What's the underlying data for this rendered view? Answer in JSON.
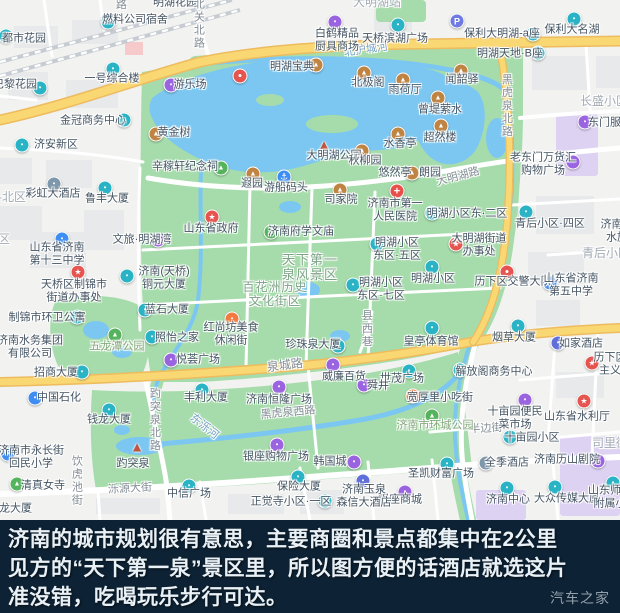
{
  "colors": {
    "base": "#f2f3f1",
    "block": "#e7e9ea",
    "park_green": "#a6dcab",
    "water_blue": "#7cc7f1",
    "road_yellow": "#f9d873",
    "road_yellow_edge": "#eebb5e",
    "road_white": "#ffffff",
    "railway": "#c6ccd2",
    "purple_block": "#ded2f3",
    "pink_block": "#f6caca",
    "caption_bg": "#0d2234",
    "caption_fg": "#e9f1f6",
    "icon_teal": "#29b3c5",
    "icon_purple": "#9a63e0",
    "icon_amber": "#c08442",
    "icon_blue": "#3e8df2",
    "icon_green": "#54b35c",
    "icon_red": "#e65450",
    "icon_orange": "#f27a40"
  },
  "map": {
    "icon_glyphs": {
      "teal": "▪",
      "purple": "▪",
      "amber": "▲",
      "blue": "▪",
      "green": "▲",
      "slate": "▪",
      "indigo": "▪",
      "orange": "▪",
      "red": "▪",
      "dot": "●",
      "star": "★",
      "cross": "+",
      "parking": "P",
      "anchor": "⚓",
      "pagoda": "▲"
    },
    "labels": [
      {
        "t": "路",
        "x": 120,
        "y": 5,
        "c": "road",
        "v": 1
      },
      {
        "t": "明湖花园",
        "x": 175,
        "y": 3,
        "c": "poi"
      },
      {
        "t": "北关北路",
        "x": 198,
        "y": 24,
        "c": "road",
        "v": 1
      },
      {
        "t": "大明湖站",
        "x": 377,
        "y": 3,
        "c": "dist"
      },
      {
        "t": "北护城河",
        "x": 366,
        "y": 50,
        "c": "water",
        "r": -8
      },
      {
        "t": "黑虎泉北路",
        "x": 506,
        "y": 106,
        "c": "road",
        "v": 1
      },
      {
        "t": "大明湖路",
        "x": 458,
        "y": 177,
        "c": "road",
        "r": -15
      },
      {
        "t": "长盛小区",
        "x": 604,
        "y": 102,
        "c": "dist"
      },
      {
        "t": "青后小区",
        "x": 606,
        "y": 254,
        "c": "dist"
      },
      {
        "t": "司里街",
        "x": 610,
        "y": 444,
        "c": "dist"
      },
      {
        "t": "区-北区",
        "x": 6,
        "y": 198,
        "c": "dist"
      },
      {
        "t": "区",
        "x": 4,
        "y": 240,
        "c": "dist"
      },
      {
        "t": "县西巷",
        "x": 366,
        "y": 329,
        "c": "road",
        "v": 1
      },
      {
        "t": "泉城路",
        "x": 285,
        "y": 366,
        "c": "road",
        "r": -7,
        "s": 12
      },
      {
        "t": "黑虎泉西路",
        "x": 288,
        "y": 413,
        "c": "road",
        "r": -5
      },
      {
        "t": "东泺河",
        "x": 204,
        "y": 427,
        "c": "water",
        "r": 38
      },
      {
        "t": "趵突泉北路",
        "x": 154,
        "y": 420,
        "c": "road",
        "v": 1
      },
      {
        "t": "饮虎池街",
        "x": 76,
        "y": 481,
        "c": "road",
        "v": 1
      },
      {
        "t": "泺源大街",
        "x": 130,
        "y": 489,
        "c": "road",
        "r": -3
      },
      {
        "t": "半边街",
        "x": 486,
        "y": 429,
        "c": "road",
        "r": -3
      },
      {
        "t": "天下第一|泉风景区",
        "x": 310,
        "y": 268,
        "c": "green",
        "s": 13
      },
      {
        "t": "百花洲历史|文化街区",
        "x": 275,
        "y": 295,
        "c": "green",
        "s": 12
      },
      {
        "t": "五龙潭公园",
        "x": 117,
        "y": 347,
        "c": "green2"
      },
      {
        "t": "济南市环城公园",
        "x": 435,
        "y": 426,
        "c": "green2"
      },
      {
        "t": "燃料公司宿舍",
        "x": 135,
        "y": 20,
        "c": "poi"
      },
      {
        "t": "都市花园",
        "x": 24,
        "y": 39,
        "c": "poi"
      },
      {
        "t": "白鹤精品|厨具商场",
        "x": 337,
        "y": 40,
        "c": "poi"
      },
      {
        "t": "天桥滨湖广场",
        "x": 395,
        "y": 39,
        "c": "poi"
      },
      {
        "t": "保利大名湖",
        "x": 572,
        "y": 30,
        "c": "poi"
      },
      {
        "t": "保利大明湖-a座",
        "x": 502,
        "y": 34,
        "c": "poi"
      },
      {
        "t": "明湖天地·B座",
        "x": 510,
        "y": 54,
        "c": "poi"
      },
      {
        "t": "一号综合楼",
        "x": 112,
        "y": 79,
        "c": "poi"
      },
      {
        "t": "巴黎花园",
        "x": 15,
        "y": 85,
        "c": "poi"
      },
      {
        "t": "金冠商务中心",
        "x": 93,
        "y": 121,
        "c": "poi"
      },
      {
        "t": "济安新区",
        "x": 56,
        "y": 145,
        "c": "poi"
      },
      {
        "t": "游乐场",
        "x": 190,
        "y": 85,
        "c": "poi"
      },
      {
        "t": "明湖宝典",
        "x": 292,
        "y": 67,
        "c": "poi"
      },
      {
        "t": "北极阁",
        "x": 368,
        "y": 83,
        "c": "poi"
      },
      {
        "t": "雨荷厅",
        "x": 405,
        "y": 90,
        "c": "poi"
      },
      {
        "t": "黄金树",
        "x": 174,
        "y": 133,
        "c": "poi"
      },
      {
        "t": "闻韶驿",
        "x": 462,
        "y": 80,
        "c": "poi"
      },
      {
        "t": "曾堤萦水",
        "x": 440,
        "y": 110,
        "c": "poi"
      },
      {
        "t": "超然楼",
        "x": 440,
        "y": 138,
        "c": "poi"
      },
      {
        "t": "水香亭",
        "x": 400,
        "y": 144,
        "c": "poi"
      },
      {
        "t": "大明湖公园",
        "x": 334,
        "y": 156,
        "c": "poi"
      },
      {
        "t": "秋柳园",
        "x": 365,
        "y": 161,
        "c": "poi"
      },
      {
        "t": "悠然亭",
        "x": 395,
        "y": 173,
        "c": "poi"
      },
      {
        "t": "朗园",
        "x": 430,
        "y": 173,
        "c": "poi"
      },
      {
        "t": "司家院",
        "x": 341,
        "y": 200,
        "c": "poi"
      },
      {
        "t": "游船码头",
        "x": 286,
        "y": 188,
        "c": "poi"
      },
      {
        "t": "遐园",
        "x": 252,
        "y": 184,
        "c": "poi"
      },
      {
        "t": "辛稼轩纪念祠",
        "x": 185,
        "y": 167,
        "c": "poi"
      },
      {
        "t": "济南市第一|人民医院",
        "x": 395,
        "y": 210,
        "c": "poi"
      },
      {
        "t": "明湖小区东·二区",
        "x": 467,
        "y": 214,
        "c": "poi"
      },
      {
        "t": "青后小区·四区",
        "x": 550,
        "y": 224,
        "c": "poi"
      },
      {
        "t": "文旅·明湖湾",
        "x": 142,
        "y": 240,
        "c": "poi"
      },
      {
        "t": "彩虹大酒店",
        "x": 53,
        "y": 194,
        "c": "poi"
      },
      {
        "t": "鲁丰大厦",
        "x": 107,
        "y": 199,
        "c": "poi"
      },
      {
        "t": "山东省济南|第十三中学",
        "x": 57,
        "y": 254,
        "c": "poi"
      },
      {
        "t": "山东省政府",
        "x": 211,
        "y": 229,
        "c": "poi"
      },
      {
        "t": "济南府学文庙",
        "x": 301,
        "y": 232,
        "c": "poi"
      },
      {
        "t": "天桥区制锦市|街道办事处",
        "x": 74,
        "y": 291,
        "c": "poi"
      },
      {
        "t": "济南(天桥)|铜元大厦",
        "x": 164,
        "y": 278,
        "c": "poi"
      },
      {
        "t": "蓝石大厦",
        "x": 167,
        "y": 310,
        "c": "poi"
      },
      {
        "t": "明湖小区|东区·五区",
        "x": 397,
        "y": 249,
        "c": "poi"
      },
      {
        "t": "明湖小区|东区·七区",
        "x": 381,
        "y": 289,
        "c": "poi"
      },
      {
        "t": "明湖小区",
        "x": 433,
        "y": 279,
        "c": "poi"
      },
      {
        "t": "大明湖街道|办事处",
        "x": 479,
        "y": 245,
        "c": "poi"
      },
      {
        "t": "历下区交警大队",
        "x": 513,
        "y": 282,
        "c": "poi"
      },
      {
        "t": "济南解|水族",
        "x": 617,
        "y": 231,
        "c": "poi"
      },
      {
        "t": "山东省济南|第五中学",
        "x": 571,
        "y": 285,
        "c": "poi"
      },
      {
        "t": "东门服装",
        "x": 610,
        "y": 123,
        "c": "poi"
      },
      {
        "t": "老东门万货汇|购物广场",
        "x": 543,
        "y": 164,
        "c": "poi"
      },
      {
        "t": "历下区|主义",
        "x": 610,
        "y": 364,
        "c": "poi"
      },
      {
        "t": "山东省水利厅",
        "x": 577,
        "y": 417,
        "c": "poi"
      },
      {
        "t": "烟草大厦",
        "x": 514,
        "y": 338,
        "c": "poi"
      },
      {
        "t": "如家酒店",
        "x": 581,
        "y": 344,
        "c": "poi"
      },
      {
        "t": "皇亭体育馆",
        "x": 431,
        "y": 342,
        "c": "poi"
      },
      {
        "t": "解放阁商务中心",
        "x": 494,
        "y": 372,
        "c": "poi"
      },
      {
        "t": "世茂广场",
        "x": 402,
        "y": 379,
        "c": "poi"
      },
      {
        "t": "宽厚里小吃街",
        "x": 440,
        "y": 398,
        "c": "poi"
      },
      {
        "t": "十亩园便民|菜市场",
        "x": 515,
        "y": 418,
        "c": "poi"
      },
      {
        "t": "十亩园小区",
        "x": 532,
        "y": 438,
        "c": "poi"
      },
      {
        "t": "全季酒店",
        "x": 507,
        "y": 463,
        "c": "poi"
      },
      {
        "t": "济南历山剧院",
        "x": 567,
        "y": 460,
        "c": "poi"
      },
      {
        "t": "圣凯财富广场",
        "x": 441,
        "y": 474,
        "c": "poi"
      },
      {
        "t": "济南中心",
        "x": 508,
        "y": 500,
        "c": "poi"
      },
      {
        "t": "大众传媒大厦",
        "x": 567,
        "y": 499,
        "c": "poi"
      },
      {
        "t": "山东师范|附属小",
        "x": 610,
        "y": 497,
        "c": "poi"
      },
      {
        "t": "银座商城",
        "x": 400,
        "y": 500,
        "c": "poi"
      },
      {
        "t": "保险大厦",
        "x": 299,
        "y": 487,
        "c": "poi"
      },
      {
        "t": "正觉寺小区·一区",
        "x": 291,
        "y": 502,
        "c": "poi"
      },
      {
        "t": "济南玉泉|森信大酒店",
        "x": 364,
        "y": 496,
        "c": "poi"
      },
      {
        "t": "韩国城",
        "x": 330,
        "y": 462,
        "c": "poi"
      },
      {
        "t": "银座购物广场",
        "x": 276,
        "y": 457,
        "c": "poi"
      },
      {
        "t": "中信广场",
        "x": 189,
        "y": 494,
        "c": "poi"
      },
      {
        "t": "金龙大厦",
        "x": 10,
        "y": 509,
        "c": "poi"
      },
      {
        "t": "趵突泉",
        "x": 133,
        "y": 464,
        "c": "poi"
      },
      {
        "t": "清真女寺",
        "x": 43,
        "y": 486,
        "c": "poi"
      },
      {
        "t": "济南市永长街|回民小学",
        "x": 31,
        "y": 457,
        "c": "poi"
      },
      {
        "t": "中国石化",
        "x": 59,
        "y": 398,
        "c": "poi"
      },
      {
        "t": "招商大厦",
        "x": 56,
        "y": 373,
        "c": "poi"
      },
      {
        "t": "济南水务集团|有限公司",
        "x": 30,
        "y": 347,
        "c": "poi"
      },
      {
        "t": "制锦市环卫公寓",
        "x": 47,
        "y": 318,
        "c": "poi"
      },
      {
        "t": "照怡之家",
        "x": 177,
        "y": 338,
        "c": "poi"
      },
      {
        "t": "悦荟广场",
        "x": 198,
        "y": 360,
        "c": "poi"
      },
      {
        "t": "丰利大厦",
        "x": 206,
        "y": 398,
        "c": "poi"
      },
      {
        "t": "钱龙大厦",
        "x": 109,
        "y": 420,
        "c": "poi"
      },
      {
        "t": "济南恒隆广场",
        "x": 279,
        "y": 400,
        "c": "poi"
      },
      {
        "t": "珍珠泉大厦",
        "x": 313,
        "y": 345,
        "c": "poi"
      },
      {
        "t": "威廉百货",
        "x": 344,
        "y": 377,
        "c": "poi"
      },
      {
        "t": "舜井",
        "x": 378,
        "y": 386,
        "c": "poi"
      },
      {
        "t": "红尚坊美食|休闲街",
        "x": 231,
        "y": 334,
        "c": "poi"
      }
    ],
    "icons": [
      {
        "x": 108,
        "y": 22,
        "k": "teal"
      },
      {
        "x": 6,
        "y": 36,
        "k": "teal"
      },
      {
        "x": 335,
        "y": 22,
        "k": "purple"
      },
      {
        "x": 398,
        "y": 25,
        "k": "teal"
      },
      {
        "x": 574,
        "y": 19,
        "k": "teal"
      },
      {
        "x": 533,
        "y": 34,
        "k": "teal"
      },
      {
        "x": 538,
        "y": 53,
        "k": "teal"
      },
      {
        "x": 457,
        "y": 21,
        "k": "parking"
      },
      {
        "x": 113,
        "y": 69,
        "k": "teal"
      },
      {
        "x": 40,
        "y": 88,
        "k": "teal"
      },
      {
        "x": 124,
        "y": 120,
        "k": "teal"
      },
      {
        "x": 22,
        "y": 145,
        "k": "teal"
      },
      {
        "x": 171,
        "y": 85,
        "k": "purple"
      },
      {
        "x": 316,
        "y": 65,
        "k": "amber"
      },
      {
        "x": 240,
        "y": 76,
        "k": "dot"
      },
      {
        "x": 364,
        "y": 73,
        "k": "amber"
      },
      {
        "x": 403,
        "y": 80,
        "k": "amber"
      },
      {
        "x": 156,
        "y": 134,
        "k": "amber"
      },
      {
        "x": 461,
        "y": 71,
        "k": "amber"
      },
      {
        "x": 438,
        "y": 98,
        "k": "amber"
      },
      {
        "x": 441,
        "y": 126,
        "k": "amber"
      },
      {
        "x": 398,
        "y": 134,
        "k": "amber"
      },
      {
        "x": 324,
        "y": 144,
        "k": "pagoda"
      },
      {
        "x": 362,
        "y": 151,
        "k": "amber"
      },
      {
        "x": 412,
        "y": 173,
        "k": "amber"
      },
      {
        "x": 253,
        "y": 174,
        "k": "amber"
      },
      {
        "x": 340,
        "y": 190,
        "k": "amber"
      },
      {
        "x": 284,
        "y": 177,
        "k": "anchor"
      },
      {
        "x": 221,
        "y": 168,
        "k": "green"
      },
      {
        "x": 397,
        "y": 191,
        "k": "cross"
      },
      {
        "x": 432,
        "y": 213,
        "k": "teal"
      },
      {
        "x": 526,
        "y": 212,
        "k": "teal"
      },
      {
        "x": 62,
        "y": 239,
        "k": "blue"
      },
      {
        "x": 54,
        "y": 184,
        "k": "slate"
      },
      {
        "x": 105,
        "y": 188,
        "k": "teal"
      },
      {
        "x": 212,
        "y": 217,
        "k": "star"
      },
      {
        "x": 271,
        "y": 232,
        "k": "green"
      },
      {
        "x": 78,
        "y": 272,
        "k": "star"
      },
      {
        "x": 127,
        "y": 276,
        "k": "teal"
      },
      {
        "x": 145,
        "y": 310,
        "k": "teal"
      },
      {
        "x": 377,
        "y": 244,
        "k": "teal"
      },
      {
        "x": 353,
        "y": 285,
        "k": "teal"
      },
      {
        "x": 158,
        "y": 240,
        "k": "purple"
      },
      {
        "x": 432,
        "y": 267,
        "k": "teal"
      },
      {
        "x": 456,
        "y": 244,
        "k": "star"
      },
      {
        "x": 507,
        "y": 272,
        "k": "dot"
      },
      {
        "x": 550,
        "y": 283,
        "k": "blue"
      },
      {
        "x": 585,
        "y": 122,
        "k": "purple"
      },
      {
        "x": 573,
        "y": 162,
        "k": "purple"
      },
      {
        "x": 592,
        "y": 363,
        "k": "star"
      },
      {
        "x": 584,
        "y": 401,
        "k": "star"
      },
      {
        "x": 518,
        "y": 326,
        "k": "teal"
      },
      {
        "x": 558,
        "y": 343,
        "k": "indigo"
      },
      {
        "x": 432,
        "y": 328,
        "k": "teal"
      },
      {
        "x": 460,
        "y": 370,
        "k": "teal"
      },
      {
        "x": 409,
        "y": 371,
        "k": "teal"
      },
      {
        "x": 413,
        "y": 396,
        "k": "orange"
      },
      {
        "x": 432,
        "y": 416,
        "k": "green"
      },
      {
        "x": 525,
        "y": 400,
        "k": "purple"
      },
      {
        "x": 510,
        "y": 437,
        "k": "teal"
      },
      {
        "x": 486,
        "y": 463,
        "k": "slate"
      },
      {
        "x": 598,
        "y": 461,
        "k": "purple"
      },
      {
        "x": 447,
        "y": 464,
        "k": "teal"
      },
      {
        "x": 507,
        "y": 488,
        "k": "teal"
      },
      {
        "x": 555,
        "y": 487,
        "k": "teal"
      },
      {
        "x": 613,
        "y": 483,
        "k": "teal"
      },
      {
        "x": 405,
        "y": 492,
        "k": "purple"
      },
      {
        "x": 298,
        "y": 477,
        "k": "teal"
      },
      {
        "x": 325,
        "y": 501,
        "k": "teal"
      },
      {
        "x": 363,
        "y": 481,
        "k": "indigo"
      },
      {
        "x": 354,
        "y": 462,
        "k": "purple"
      },
      {
        "x": 277,
        "y": 445,
        "k": "purple"
      },
      {
        "x": 189,
        "y": 486,
        "k": "teal"
      },
      {
        "x": 137,
        "y": 446,
        "k": "pagoda"
      },
      {
        "x": 17,
        "y": 484,
        "k": "green"
      },
      {
        "x": 8,
        "y": 454,
        "k": "blue"
      },
      {
        "x": 35,
        "y": 398,
        "k": "blue"
      },
      {
        "x": 82,
        "y": 372,
        "k": "teal"
      },
      {
        "x": 77,
        "y": 317,
        "k": "teal"
      },
      {
        "x": 115,
        "y": 335,
        "k": "green"
      },
      {
        "x": 152,
        "y": 337,
        "k": "teal"
      },
      {
        "x": 171,
        "y": 360,
        "k": "purple"
      },
      {
        "x": 202,
        "y": 390,
        "k": "teal"
      },
      {
        "x": 109,
        "y": 410,
        "k": "teal"
      },
      {
        "x": 279,
        "y": 387,
        "k": "purple"
      },
      {
        "x": 333,
        "y": 365,
        "k": "purple"
      },
      {
        "x": 364,
        "y": 385,
        "k": "purple"
      },
      {
        "x": 338,
        "y": 346,
        "k": "teal"
      },
      {
        "x": 232,
        "y": 319,
        "k": "orange"
      }
    ]
  },
  "caption": {
    "lines": [
      "济南的城市规划很有意思，主要商圈和景点都集中在2公里",
      "见方的“天下第一泉”景区里，所以图方便的话酒店就选这片",
      "准没错，吃喝玩乐步行可达。"
    ],
    "watermark": "汽车之家"
  }
}
